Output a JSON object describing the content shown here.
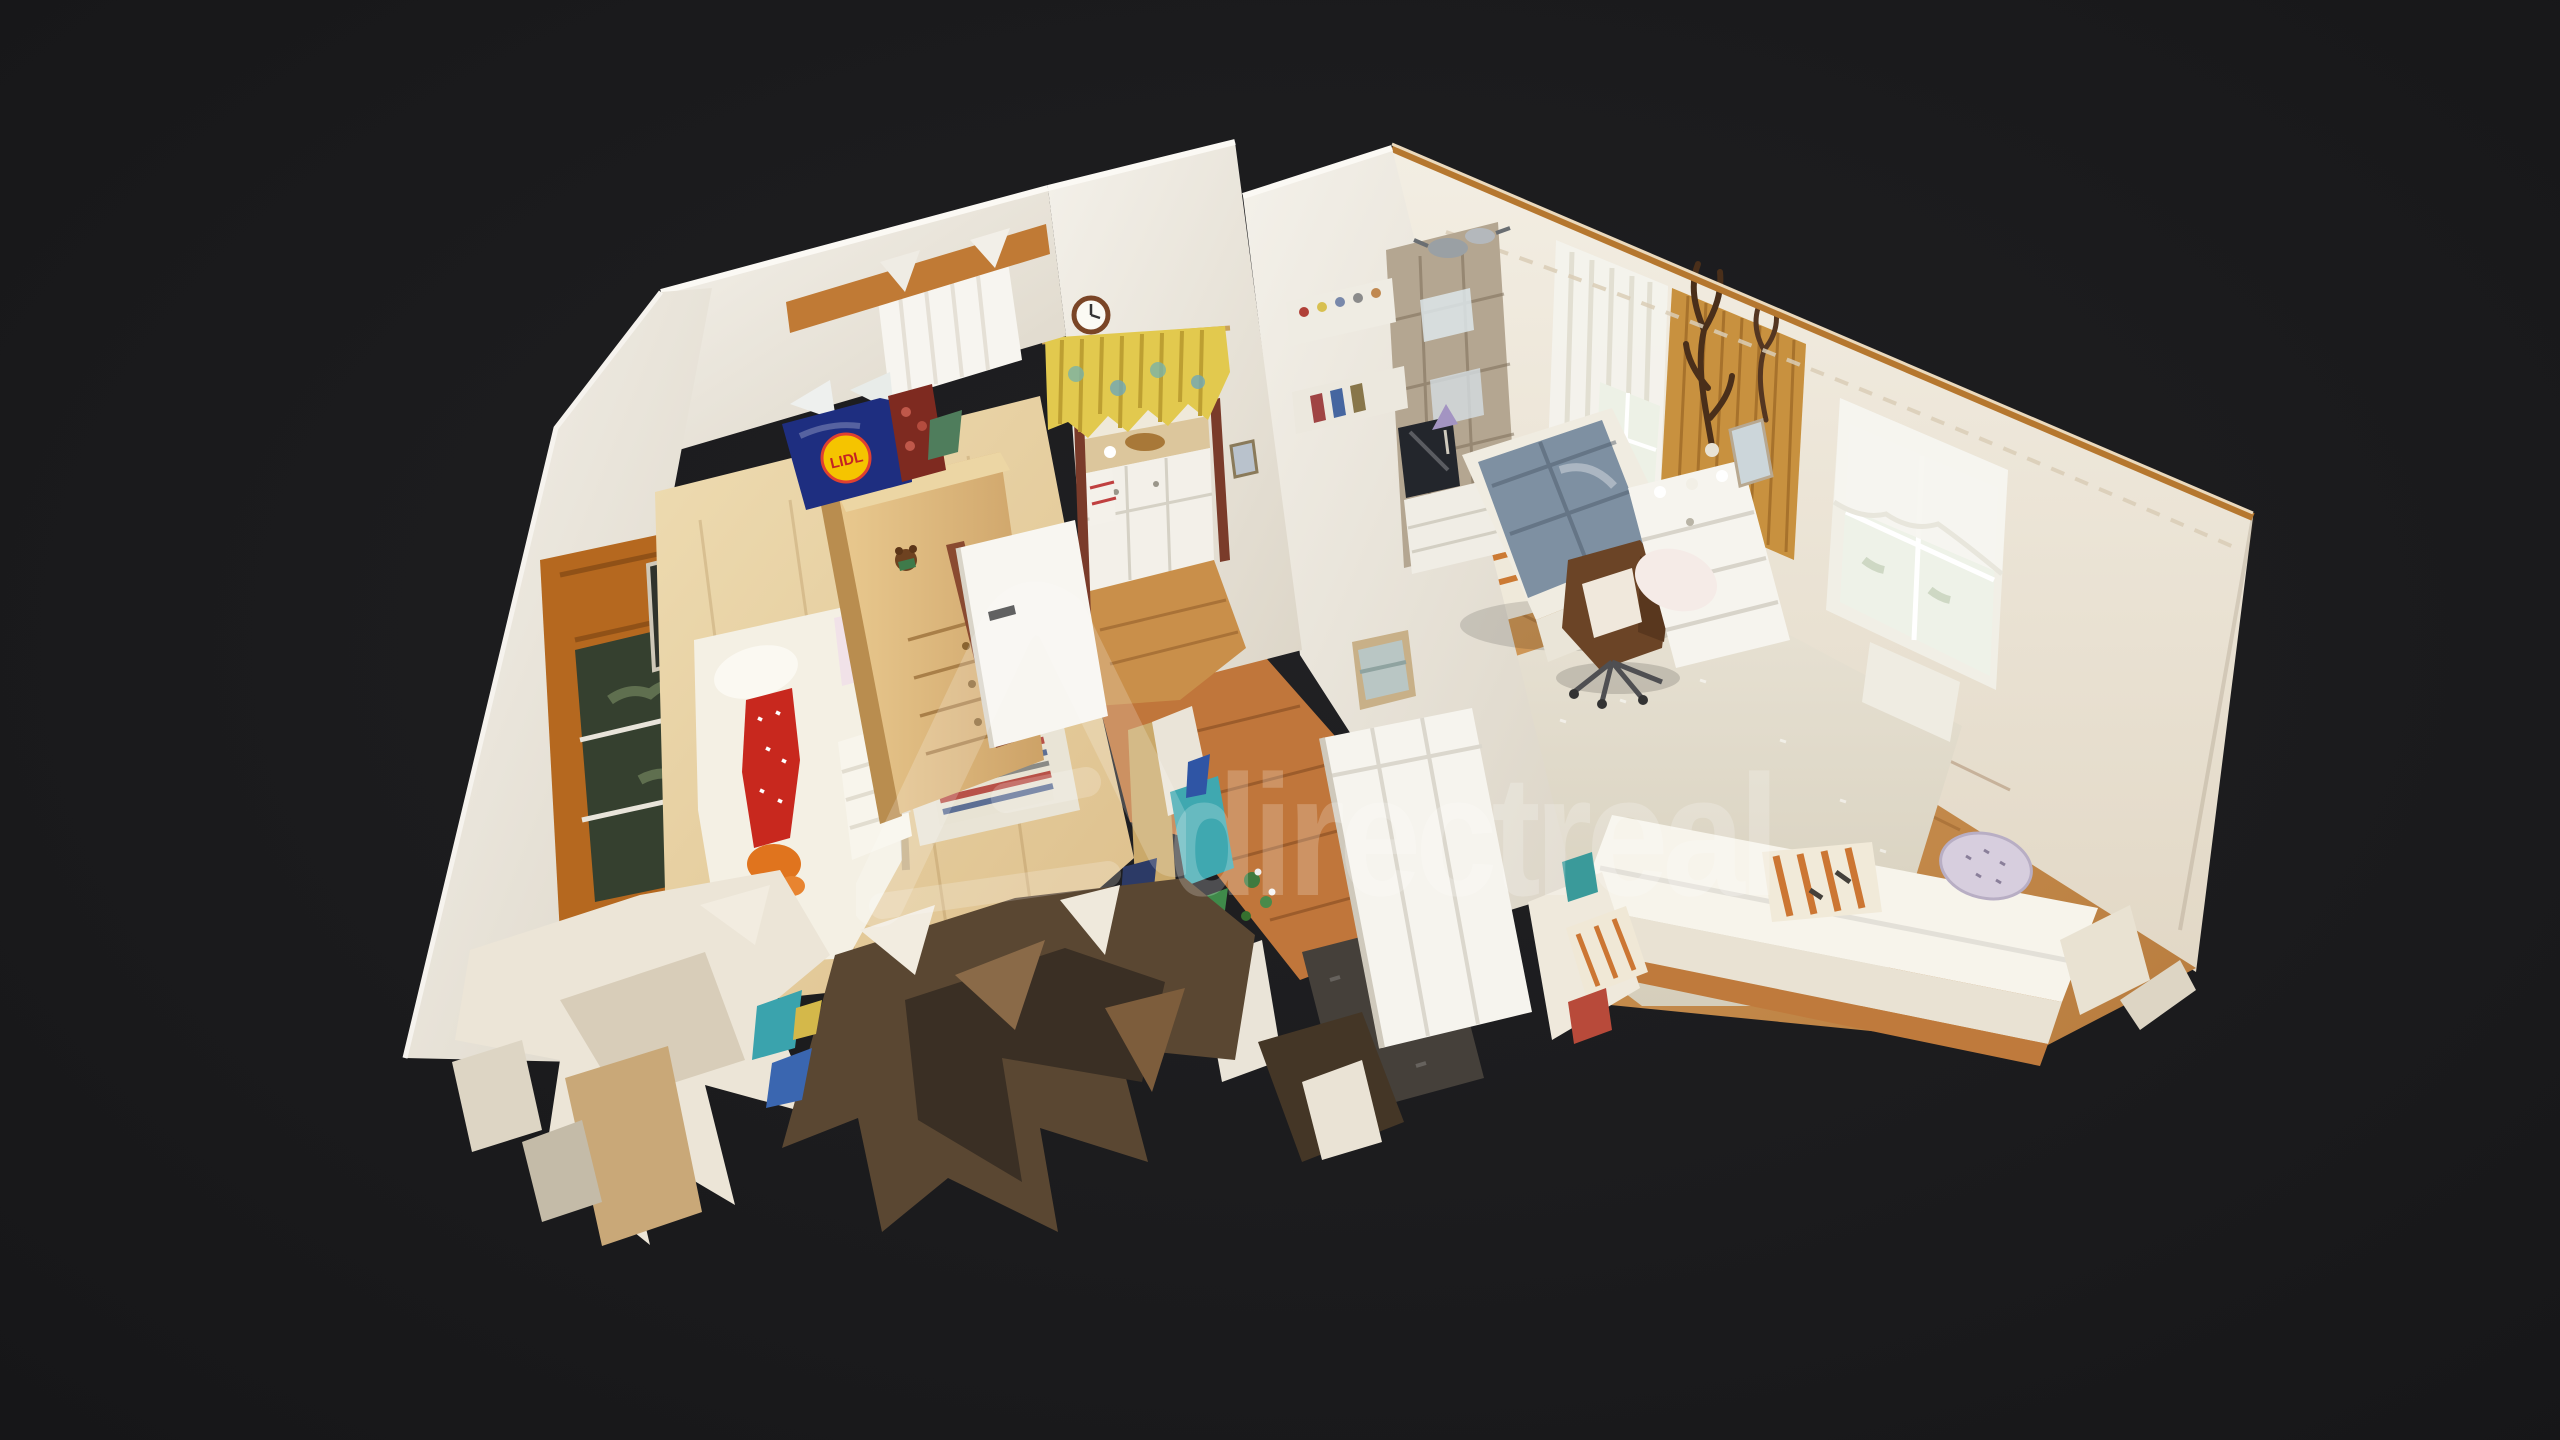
{
  "app": {
    "name": "3D virtual tour viewer",
    "view_mode": "dollhouse"
  },
  "canvas": {
    "width": 2560,
    "height": 1440,
    "background_color": "#1b1b1d"
  },
  "watermark": {
    "logo": "directreal-chevron-logo",
    "text": "directreal",
    "color": "#ffffff",
    "opacity": 0.21
  },
  "branding": {
    "lidl": {
      "text": "LIDL",
      "bag_color": "#1e2e80",
      "circle_color": "#f5c400",
      "text_color": "#c42323"
    }
  },
  "scene": {
    "type": "photogrammetry-dollhouse-scan",
    "rooms": [
      {
        "id": "children-bedroom",
        "objects": [
          "bed",
          "white-pillow",
          "floral-pillow",
          "red-pillow",
          "orange-plush-toy",
          "quilted-blanket",
          "wardrobe",
          "teddy-bear",
          "white-door",
          "striped-rug",
          "garden-window",
          "wall-picture",
          "wooden-beam",
          "net-curtain",
          "lidl-bag",
          "apples-bag"
        ]
      },
      {
        "id": "kitchen",
        "objects": [
          "wall-clock",
          "yellow-floral-valance",
          "counter",
          "bread-basket",
          "white-cabinets",
          "embroidered-cloth",
          "wood-floor"
        ]
      },
      {
        "id": "hallway",
        "objects": [
          "wood-floor",
          "doormat",
          "white-sliding-door",
          "torn-mesh-shards",
          "plant-debris"
        ]
      },
      {
        "id": "living-room",
        "objects": [
          "gray-blue-sofa",
          "white-armchair",
          "leather-swivel-chair",
          "white-dresser",
          "mirror",
          "rustic-shelving-unit",
          "tv",
          "table-lamp",
          "trinket-shelves",
          "lace-curtain-window-left",
          "wood-paneling",
          "antlers-trophy",
          "lace-curtain-window-right",
          "radiator",
          "beige-carpet",
          "orange-striped-runner",
          "striped-cushion",
          "daybed",
          "floral-bolster-pillow",
          "framed-painting",
          "garland"
        ]
      }
    ],
    "artifacts": [
      "torn-mesh-fragments-bottom",
      "colorful-debris-center",
      "white-shards"
    ]
  },
  "palette": {
    "background": "#1b1b1d",
    "wall": "#f2efe8",
    "wall_cut_edge_light": "#faf8f3",
    "wall_cut_edge_orange": "#b5772f",
    "bedroom_floor": "#e7d4a7",
    "hall_floor": "#c0763b",
    "living_floor": "#cb9354",
    "carpet": "#e2dccc",
    "sofa_cushion": "#7e90a2",
    "swivel_chair": "#6b4426",
    "valance_yellow": "#e2c94e",
    "rug_red": "#b85148",
    "rug_blue": "#5d6f94"
  }
}
